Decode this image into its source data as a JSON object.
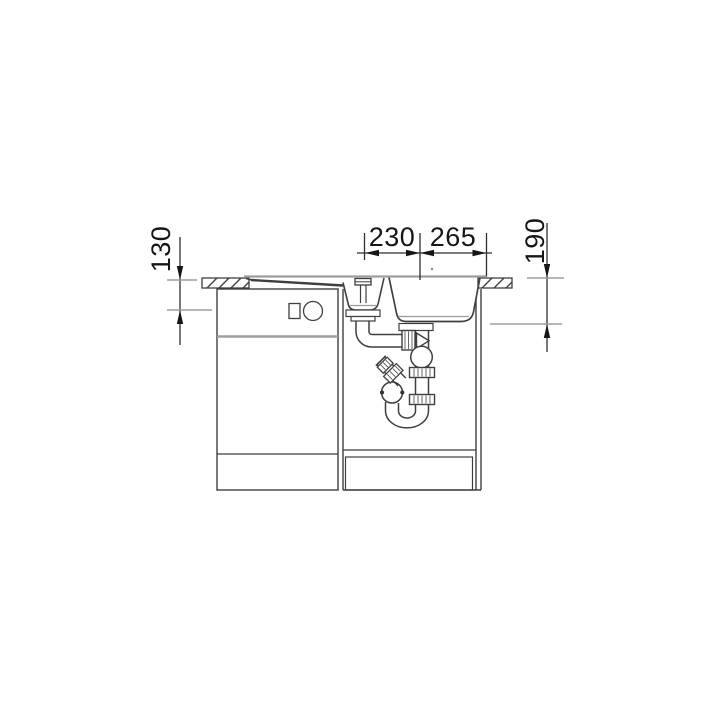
{
  "colors": {
    "background": "#ffffff",
    "line": "#3f3f3f",
    "dimension": "#1a1a1a",
    "tick": "#9e9e9e"
  },
  "dimensions": {
    "top_left": "230",
    "top_right": "265",
    "left": "130",
    "right": "190"
  }
}
